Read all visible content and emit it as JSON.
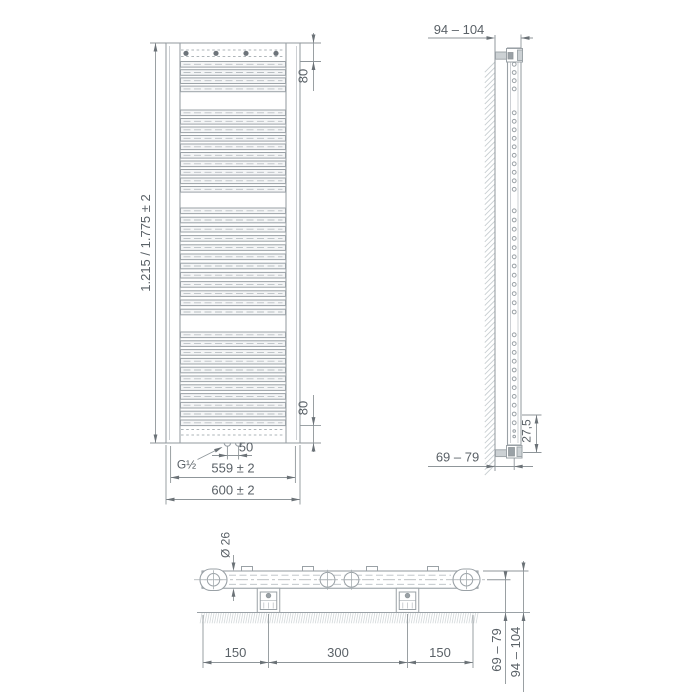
{
  "meta": {
    "type": "technical-drawing",
    "subject": "flat bathroom towel radiator installation drawing",
    "views": [
      "front",
      "side",
      "top"
    ]
  },
  "labels": {
    "height": "1.215 / 1.775 ± 2",
    "top_offset": "80",
    "bottom_offset": "80",
    "thread": "G½",
    "connection_spacing": "50",
    "connection_width": "559 ± 2",
    "overall_width": "600 ± 2",
    "side_depth_overall": "94 – 104",
    "side_bottom_offset": "27,5",
    "side_depth_to_center": "69 – 79",
    "tube_diameter": "Ø 26",
    "bracket_offset_left": "150",
    "bracket_spacing_center": "300",
    "bracket_offset_right": "150",
    "top_depth_to_center": "69 – 79",
    "top_depth_overall": "94 – 104"
  },
  "structure": {
    "tube_groups": [
      4,
      10,
      12,
      11
    ],
    "mounting_dots_front": 4,
    "wall_brackets_top_view": 2,
    "center_connections": 2,
    "end_caps_top_view": 2
  },
  "colors": {
    "line": "#9aa1a6",
    "dim_line": "#8f969a",
    "text": "#5a6167",
    "arrow": "#6b7277",
    "background": "#ffffff"
  }
}
